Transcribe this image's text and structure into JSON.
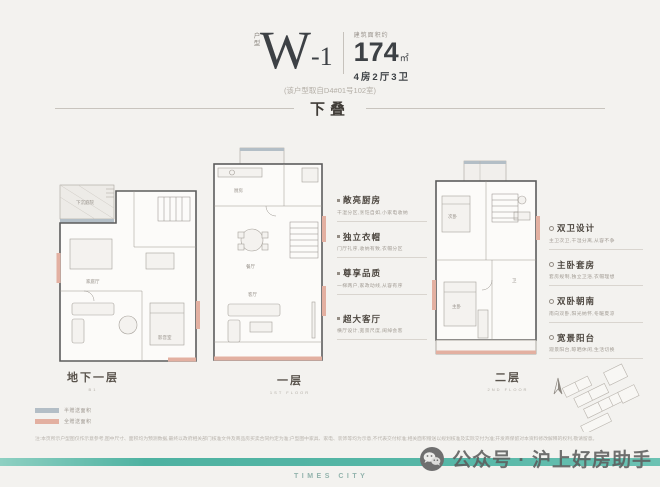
{
  "header": {
    "unit_label": "户型",
    "unit_name": "W",
    "unit_number": "-1",
    "area_prefix": "建筑面积约",
    "area_value": "174",
    "area_unit": "㎡",
    "layout": "4房2厅3卫",
    "source_note": "(该户型取自D4#01号102室)",
    "section_title": "下叠"
  },
  "floors": {
    "b1": {
      "label": "地下一层",
      "sublabel": "B1",
      "rooms": {
        "court": "下沉庭院",
        "family": "家庭厅",
        "media": "影音室"
      }
    },
    "f1": {
      "label": "一层",
      "sublabel": "1ST FLOOR",
      "rooms": {
        "kitchen": "厨房",
        "dining": "餐厅",
        "living": "客厅"
      }
    },
    "f2": {
      "label": "二层",
      "sublabel": "2ND FLOOR",
      "rooms": {
        "second": "次卧",
        "master": "主卧",
        "bath": "卫"
      }
    }
  },
  "annotations_center": [
    {
      "title": "敞亮厨房",
      "desc": "干湿分区,烹饪自如,小家电收纳"
    },
    {
      "title": "独立衣帽",
      "desc": "门厅礼序,收纳有致,衣帽分区"
    },
    {
      "title": "尊享品质",
      "desc": "一梯两户,家政动线,从容有序"
    },
    {
      "title": "超大客厅",
      "desc": "横厅设计,宽景尺度,阔绰会客"
    }
  ],
  "annotations_right": [
    {
      "title": "双卫设计",
      "desc": "主卫次卫,干湿分离,从容不争"
    },
    {
      "title": "主卧套房",
      "desc": "套房规制,独立卫浴,衣帽理想"
    },
    {
      "title": "双卧朝南",
      "desc": "南向双卧,阳光纳怀,冬暖夏凉"
    },
    {
      "title": "宽景阳台",
      "desc": "观景阳台,晾晒休闲,生活切换"
    }
  ],
  "legend": [
    {
      "color": "#b3bec6",
      "label": "半赠送面积"
    },
    {
      "color": "#e3b0a1",
      "label": "全赠送面积"
    }
  ],
  "disclaimer": "注:本页所示户型图仅作示意参考,图中尺寸、面积均为预测数据,最终以政府相关部门核准文件及商品房买卖合同约定为准;户型图中家具、家电、装饰等均为示意,不代表交付标准;相关面积赠送以规划核准及实际交付为准;开发商保留对本资料修改解释的权利,敬请留意。",
  "watermark": {
    "text": "公众号 · 沪上好房助手"
  },
  "brand": "TIMES CITY",
  "colors": {
    "accent_teal": "#54b6a6",
    "salmon": "#e3b0a1",
    "grayblue": "#b3bec6"
  }
}
